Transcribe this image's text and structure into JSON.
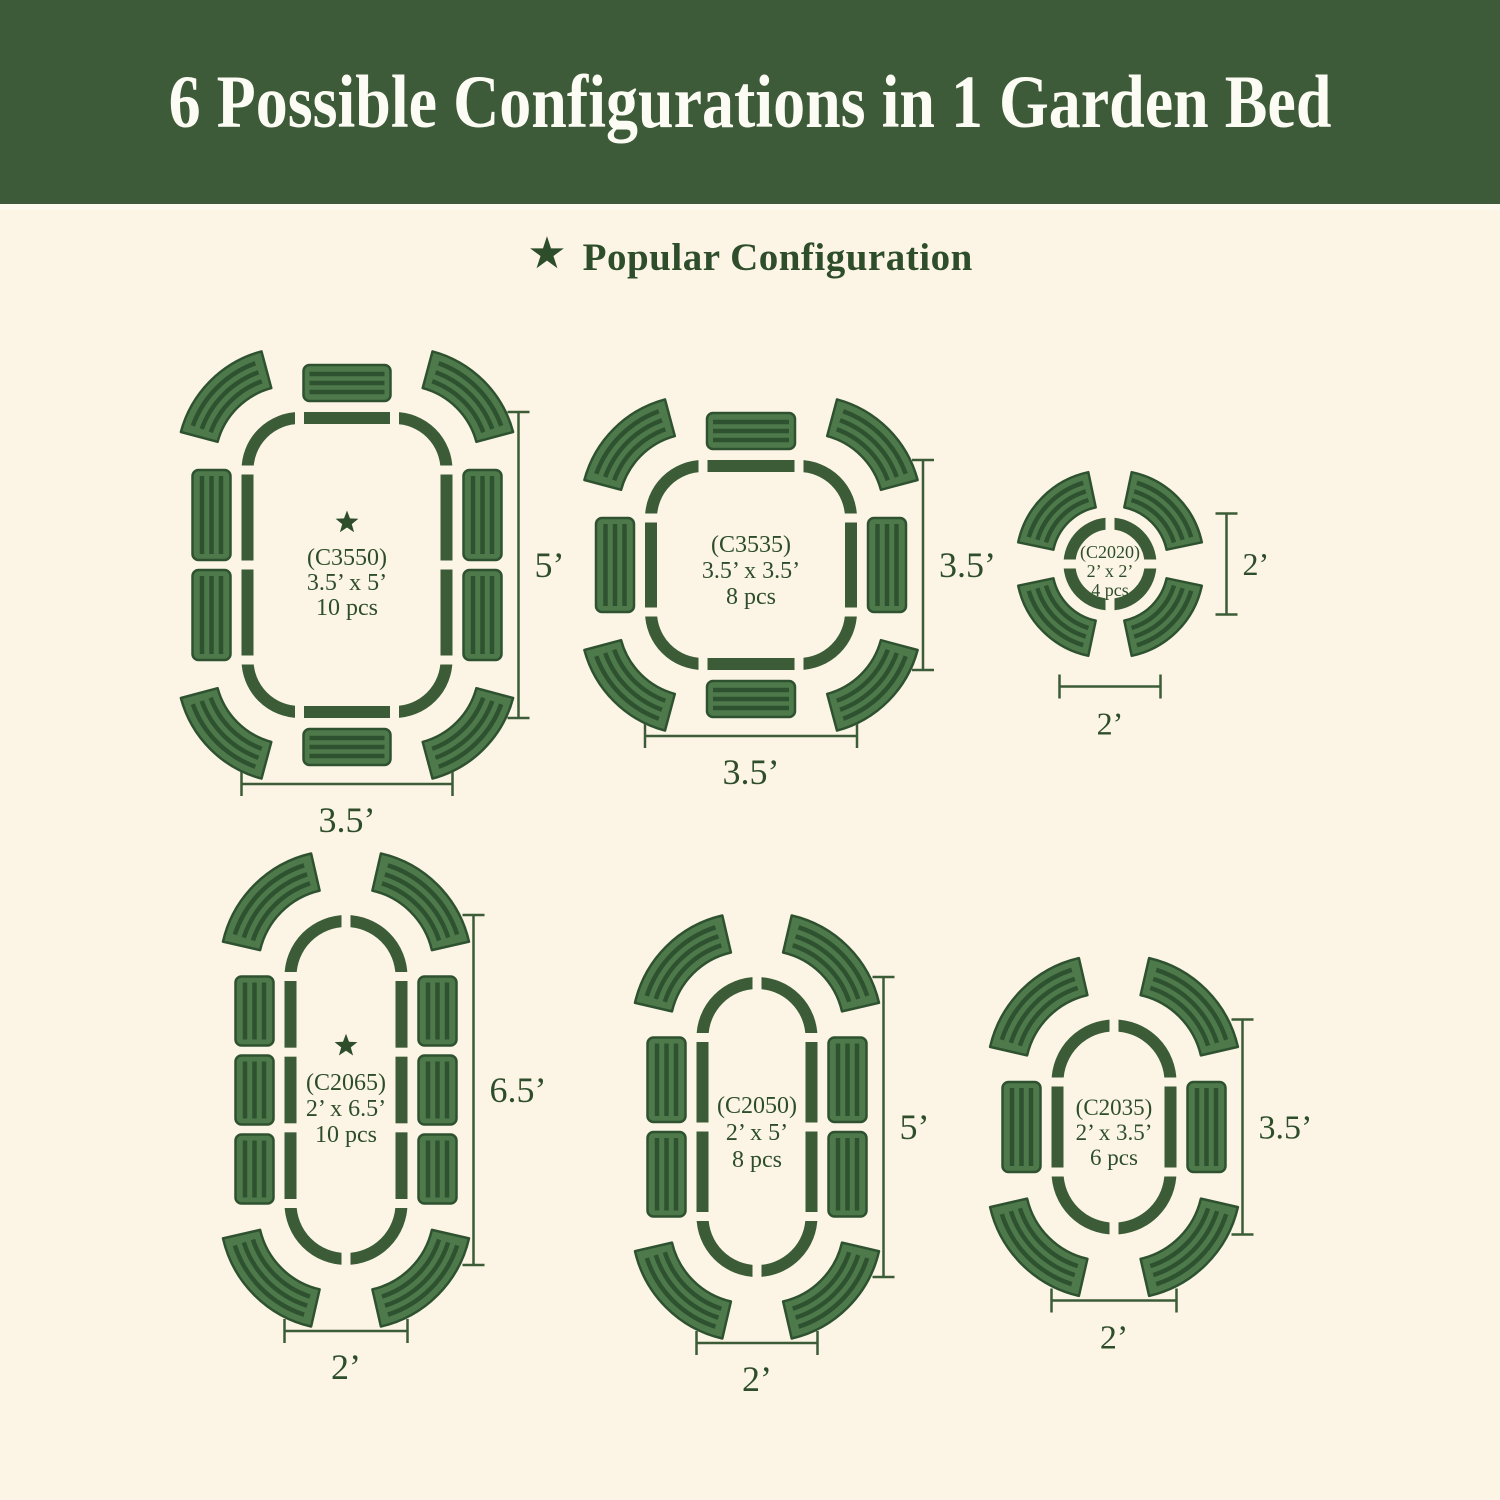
{
  "header": {
    "title": "6 Possible Configurations in 1 Garden Bed"
  },
  "legend": {
    "star_icon": "★",
    "label": "Popular Configuration"
  },
  "colors": {
    "background": "#fcf5e6",
    "header_bg": "#3d5b39",
    "header_text": "#fdfcf4",
    "outline": "#3b5c37",
    "text_green": "#2e4e2b",
    "piece_light": "#4e7a4b",
    "piece_dark": "#2e5230"
  },
  "configurations": [
    {
      "id": "C3550",
      "code": "(C3550)",
      "size": "3.5’ x 5’",
      "pieces": "10 pcs",
      "popular": true,
      "dim_right": "5’",
      "dim_bottom": "3.5’",
      "geometry": {
        "shape": "roundrect",
        "cx": 347,
        "cy": 565,
        "w": 199,
        "h": 294,
        "r": 52,
        "side_segments": 2,
        "top_segments": 1,
        "font_size": 24,
        "line_spacing": 25,
        "dim_font": 36
      }
    },
    {
      "id": "C3535",
      "code": "(C3535)",
      "size": "3.5’ x 3.5’",
      "pieces": "8 pcs",
      "popular": false,
      "dim_right": "3.5’",
      "dim_bottom": "3.5’",
      "geometry": {
        "shape": "roundrect",
        "cx": 751,
        "cy": 565,
        "w": 200,
        "h": 198,
        "r": 52,
        "side_segments": 1,
        "top_segments": 1,
        "font_size": 24,
        "line_spacing": 26,
        "dim_font": 36
      }
    },
    {
      "id": "C2020",
      "code": "(C2020)",
      "size": "2’ x 2’",
      "pieces": "4 pcs",
      "popular": false,
      "dim_right": "2’",
      "dim_bottom": "2’",
      "geometry": {
        "shape": "circle",
        "cx": 1110,
        "cy": 564,
        "ring_r": 40.5,
        "ring_sw": 12,
        "font_size": 18,
        "line_spacing": 19,
        "dim_font": 32
      }
    },
    {
      "id": "C2065",
      "code": "(C2065)",
      "size": "2’ x 6.5’",
      "pieces": "10 pcs",
      "popular": true,
      "dim_right": "6.5’",
      "dim_bottom": "2’",
      "geometry": {
        "shape": "pill",
        "cx": 346,
        "cy": 1090,
        "w": 111,
        "h": 338,
        "r": 55.5,
        "side_segments": 3,
        "top_segments": 0,
        "font_size": 24,
        "line_spacing": 26,
        "dim_font": 36
      }
    },
    {
      "id": "C2050",
      "code": "(C2050)",
      "size": "2’ x 5’",
      "pieces": "8 pcs",
      "popular": false,
      "dim_right": "5’",
      "dim_bottom": "2’",
      "geometry": {
        "shape": "pill",
        "cx": 757,
        "cy": 1127,
        "w": 109,
        "h": 288,
        "r": 54.5,
        "side_segments": 2,
        "top_segments": 0,
        "font_size": 24,
        "line_spacing": 27,
        "dim_font": 36
      }
    },
    {
      "id": "C2035",
      "code": "(C2035)",
      "size": "2’ x 3.5’",
      "pieces": "6 pcs",
      "popular": false,
      "dim_right": "3.5’",
      "dim_bottom": "2’",
      "geometry": {
        "shape": "pill",
        "cx": 1114,
        "cy": 1127,
        "w": 113,
        "h": 203,
        "r": 56.5,
        "side_segments": 1,
        "top_segments": 0,
        "font_size": 23,
        "line_spacing": 25,
        "dim_font": 34
      }
    }
  ]
}
